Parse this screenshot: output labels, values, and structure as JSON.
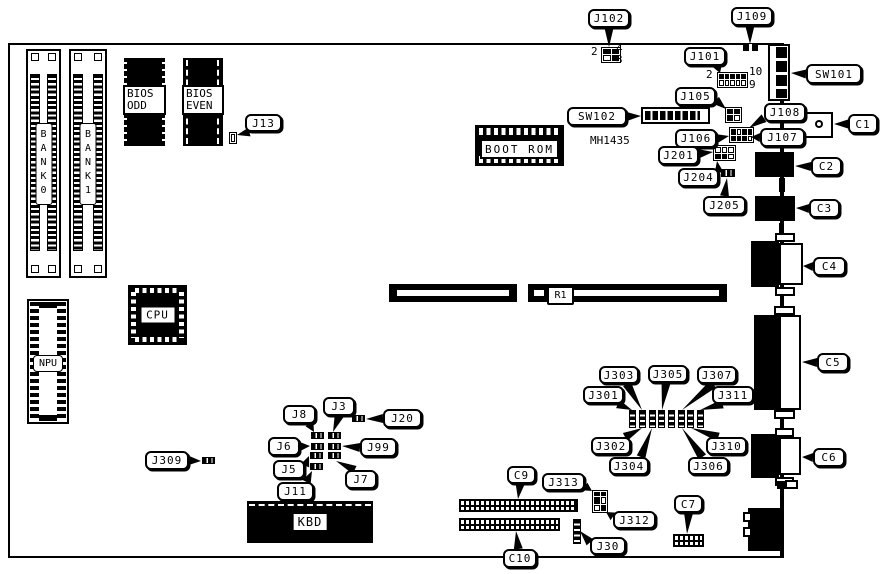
{
  "figure": {
    "width": 881,
    "height": 574,
    "ink": "#000000",
    "paper": "#ffffff"
  },
  "board": {
    "x": 8,
    "y": 43,
    "w": 770,
    "h": 511
  },
  "components": {
    "bank0": {
      "label": "BANK0"
    },
    "bank1": {
      "label": "BANK1"
    },
    "bios_odd": {
      "line1": "BIOS",
      "line2": "ODD"
    },
    "bios_even": {
      "line1": "BIOS",
      "line2": "EVEN"
    },
    "boot_rom": {
      "label": "BOOT ROM"
    },
    "cpu": {
      "label": "CPU"
    },
    "npu": {
      "label": "NPU"
    },
    "kbd": {
      "label": "KBD"
    },
    "r1": {
      "label": "R1"
    }
  },
  "texts": [
    {
      "id": "j102-pin-2",
      "text": "2",
      "x": 591,
      "y": 45
    },
    {
      "id": "j102-pin-4",
      "text": "4",
      "x": 616,
      "y": 42
    },
    {
      "id": "j102-pin-3",
      "text": "3",
      "x": 616,
      "y": 53
    },
    {
      "id": "j101-pin-2",
      "text": "2",
      "x": 706,
      "y": 68
    },
    {
      "id": "j101-pin-10",
      "text": "10",
      "x": 749,
      "y": 65
    },
    {
      "id": "j101-pin-9",
      "text": "9",
      "x": 749,
      "y": 78
    },
    {
      "id": "sw102-part-number",
      "text": "MH1435",
      "x": 590,
      "y": 134
    }
  ],
  "callouts": [
    {
      "label": "J102",
      "x": 588,
      "y": 9,
      "w": 42,
      "h": 19,
      "side": "bottom",
      "off": 0.5,
      "tx": 609,
      "ty": 47
    },
    {
      "label": "J109",
      "x": 731,
      "y": 7,
      "w": 42,
      "h": 19,
      "side": "bottom",
      "off": 0.45,
      "tx": 750,
      "ty": 44
    },
    {
      "label": "J101",
      "x": 684,
      "y": 47,
      "w": 42,
      "h": 19,
      "side": "bottom",
      "off": 0.8,
      "tx": 720,
      "ty": 73
    },
    {
      "label": "SW101",
      "x": 806,
      "y": 64,
      "w": 56,
      "h": 20,
      "side": "left",
      "off": 0.5,
      "tx": 791,
      "ty": 73
    },
    {
      "label": "SW102",
      "x": 567,
      "y": 107,
      "w": 60,
      "h": 19,
      "side": "right",
      "off": 0.5,
      "tx": 641,
      "ty": 116
    },
    {
      "label": "J105",
      "x": 675,
      "y": 87,
      "w": 41,
      "h": 19,
      "side": "right",
      "off": 0.7,
      "tx": 726,
      "ty": 109
    },
    {
      "label": "J108",
      "x": 764,
      "y": 103,
      "w": 42,
      "h": 19,
      "side": "left",
      "off": 0.8,
      "tx": 749,
      "ty": 128
    },
    {
      "label": "J106",
      "x": 675,
      "y": 129,
      "w": 42,
      "h": 19,
      "side": "right",
      "off": 0.5,
      "tx": 729,
      "ty": 136
    },
    {
      "label": "J107",
      "x": 760,
      "y": 128,
      "w": 45,
      "h": 19,
      "side": "left",
      "off": 0.5,
      "tx": 751,
      "ty": 137
    },
    {
      "label": "J201",
      "x": 658,
      "y": 146,
      "w": 41,
      "h": 19,
      "side": "right",
      "off": 0.4,
      "tx": 713,
      "ty": 152
    },
    {
      "label": "J204",
      "x": 678,
      "y": 168,
      "w": 41,
      "h": 19,
      "side": "right",
      "off": 0.25,
      "tx": 717,
      "ty": 161
    },
    {
      "label": "J205",
      "x": 703,
      "y": 196,
      "w": 43,
      "h": 19,
      "side": "top",
      "off": 0.5,
      "tx": 727,
      "ty": 178
    },
    {
      "label": "C1",
      "x": 848,
      "y": 114,
      "w": 30,
      "h": 20,
      "side": "left",
      "off": 0.5,
      "tx": 834,
      "ty": 124
    },
    {
      "label": "C2",
      "x": 811,
      "y": 157,
      "w": 31,
      "h": 19,
      "side": "left",
      "off": 0.5,
      "tx": 795,
      "ty": 166
    },
    {
      "label": "C3",
      "x": 809,
      "y": 199,
      "w": 31,
      "h": 19,
      "side": "left",
      "off": 0.5,
      "tx": 796,
      "ty": 208
    },
    {
      "label": "C4",
      "x": 813,
      "y": 257,
      "w": 33,
      "h": 19,
      "side": "left",
      "off": 0.5,
      "tx": 803,
      "ty": 266
    },
    {
      "label": "C5",
      "x": 817,
      "y": 353,
      "w": 32,
      "h": 19,
      "side": "left",
      "off": 0.5,
      "tx": 802,
      "ty": 362
    },
    {
      "label": "C6",
      "x": 813,
      "y": 448,
      "w": 32,
      "h": 19,
      "side": "left",
      "off": 0.5,
      "tx": 802,
      "ty": 457
    },
    {
      "label": "J13",
      "x": 245,
      "y": 114,
      "w": 37,
      "h": 18,
      "side": "bottom",
      "off": 0.12,
      "tx": 237,
      "ty": 135
    },
    {
      "label": "J309",
      "x": 145,
      "y": 451,
      "w": 44,
      "h": 19,
      "side": "right",
      "off": 0.5,
      "tx": 201,
      "ty": 461
    },
    {
      "label": "J8",
      "x": 283,
      "y": 405,
      "w": 33,
      "h": 19,
      "side": "bottom",
      "off": 0.8,
      "tx": 314,
      "ty": 432
    },
    {
      "label": "J3",
      "x": 323,
      "y": 397,
      "w": 32,
      "h": 19,
      "side": "bottom",
      "off": 0.5,
      "tx": 333,
      "ty": 432
    },
    {
      "label": "J20",
      "x": 383,
      "y": 409,
      "w": 39,
      "h": 19,
      "side": "left",
      "off": 0.5,
      "tx": 366,
      "ty": 419
    },
    {
      "label": "J6",
      "x": 268,
      "y": 437,
      "w": 32,
      "h": 19,
      "side": "right",
      "off": 0.5,
      "tx": 310,
      "ty": 446
    },
    {
      "label": "J99",
      "x": 360,
      "y": 438,
      "w": 37,
      "h": 19,
      "side": "left",
      "off": 0.5,
      "tx": 342,
      "ty": 446
    },
    {
      "label": "J5",
      "x": 273,
      "y": 460,
      "w": 32,
      "h": 19,
      "side": "right",
      "off": 0.3,
      "tx": 309,
      "ty": 456
    },
    {
      "label": "J7",
      "x": 345,
      "y": 470,
      "w": 32,
      "h": 19,
      "side": "top",
      "off": 0.3,
      "tx": 336,
      "ty": 461
    },
    {
      "label": "J11",
      "x": 277,
      "y": 482,
      "w": 37,
      "h": 19,
      "side": "top",
      "off": 0.8,
      "tx": 312,
      "ty": 471
    },
    {
      "label": "J301",
      "x": 583,
      "y": 386,
      "w": 41,
      "h": 18,
      "side": "bottom",
      "off": 0.85,
      "tx": 632,
      "ty": 410
    },
    {
      "label": "J303",
      "x": 599,
      "y": 366,
      "w": 40,
      "h": 18,
      "side": "bottom",
      "off": 0.7,
      "tx": 642,
      "ty": 410
    },
    {
      "label": "J305",
      "x": 648,
      "y": 365,
      "w": 40,
      "h": 18,
      "side": "bottom",
      "off": 0.45,
      "tx": 662,
      "ty": 410
    },
    {
      "label": "J307",
      "x": 697,
      "y": 366,
      "w": 40,
      "h": 18,
      "side": "bottom",
      "off": 0.4,
      "tx": 682,
      "ty": 410
    },
    {
      "label": "J311",
      "x": 712,
      "y": 386,
      "w": 42,
      "h": 18,
      "side": "bottom",
      "off": 0.25,
      "tx": 700,
      "ty": 410
    },
    {
      "label": "J302",
      "x": 591,
      "y": 437,
      "w": 40,
      "h": 18,
      "side": "top",
      "off": 0.85,
      "tx": 642,
      "ty": 428
    },
    {
      "label": "J304",
      "x": 609,
      "y": 457,
      "w": 40,
      "h": 18,
      "side": "top",
      "off": 0.8,
      "tx": 652,
      "ty": 428
    },
    {
      "label": "J306",
      "x": 688,
      "y": 457,
      "w": 41,
      "h": 18,
      "side": "top",
      "off": 0.35,
      "tx": 682,
      "ty": 428
    },
    {
      "label": "J310",
      "x": 706,
      "y": 437,
      "w": 41,
      "h": 18,
      "side": "top",
      "off": 0.3,
      "tx": 691,
      "ty": 428
    },
    {
      "label": "C9",
      "x": 507,
      "y": 466,
      "w": 29,
      "h": 18,
      "side": "bottom",
      "off": 0.45,
      "tx": 518,
      "ty": 499
    },
    {
      "label": "C10",
      "x": 503,
      "y": 549,
      "w": 34,
      "h": 19,
      "side": "top",
      "off": 0.45,
      "tx": 516,
      "ty": 531
    },
    {
      "label": "J313",
      "x": 542,
      "y": 473,
      "w": 43,
      "h": 18,
      "side": "right",
      "off": 0.75,
      "tx": 592,
      "ty": 491
    },
    {
      "label": "J312",
      "x": 613,
      "y": 511,
      "w": 43,
      "h": 18,
      "side": "left",
      "off": 0.3,
      "tx": 606,
      "ty": 512
    },
    {
      "label": "J30",
      "x": 590,
      "y": 537,
      "w": 36,
      "h": 18,
      "side": "left",
      "off": 0.3,
      "tx": 580,
      "ty": 531
    },
    {
      "label": "C7",
      "x": 674,
      "y": 495,
      "w": 29,
      "h": 18,
      "side": "bottom",
      "off": 0.5,
      "tx": 687,
      "ty": 534
    }
  ],
  "parts": [
    {
      "id": "slot-left",
      "type": "black",
      "x": 389,
      "y": 284,
      "w": 128,
      "h": 18
    },
    {
      "id": "slot-left-stripe",
      "type": "white",
      "x": 397,
      "y": 290,
      "w": 112,
      "h": 6
    },
    {
      "id": "slot-right",
      "type": "black",
      "x": 528,
      "y": 284,
      "w": 199,
      "h": 18
    },
    {
      "id": "slot-right-stripe-a",
      "type": "white",
      "x": 534,
      "y": 290,
      "w": 10,
      "h": 6
    },
    {
      "id": "slot-right-stripe-b",
      "type": "white",
      "x": 573,
      "y": 290,
      "w": 146,
      "h": 6
    },
    {
      "id": "j109-block",
      "type": "tickrect",
      "x": 743,
      "y": 44,
      "w": 15,
      "h": 7
    },
    {
      "id": "j102-block",
      "type": "cellgrid",
      "x": 601,
      "y": 47,
      "w": 20,
      "h": 16,
      "cols": 2,
      "cells": [
        "b",
        "b",
        "w",
        "b"
      ]
    },
    {
      "id": "j101-header",
      "type": "cellgrid",
      "x": 717,
      "y": 72,
      "w": 31,
      "h": 16,
      "cols": 5,
      "cells": [
        "b",
        "b",
        "b",
        "b",
        "b",
        "w",
        "w",
        "w",
        "w",
        "w"
      ]
    },
    {
      "id": "j105-block",
      "type": "cellgrid",
      "x": 725,
      "y": 107,
      "w": 17,
      "h": 16,
      "cols": 2,
      "cells": [
        "b",
        "b",
        "b",
        "w"
      ]
    },
    {
      "id": "j106-j107-block",
      "type": "cellgrid",
      "x": 729,
      "y": 127,
      "w": 25,
      "h": 16,
      "cols": 4,
      "cells": [
        "b",
        "w",
        "b",
        "b",
        "b",
        "b",
        "b",
        "w"
      ]
    },
    {
      "id": "j201-block",
      "type": "cellgrid",
      "x": 713,
      "y": 145,
      "w": 23,
      "h": 16,
      "cols": 3,
      "cells": [
        "w",
        "w",
        "w",
        "b",
        "b",
        "w"
      ]
    },
    {
      "id": "j204-jumper",
      "type": "jmp-h",
      "x": 721,
      "y": 169,
      "w": 14,
      "h": 8
    },
    {
      "id": "j13-part",
      "type": "cellgrid",
      "x": 229,
      "y": 132,
      "w": 8,
      "h": 12,
      "cols": 1,
      "cells": [
        "w"
      ]
    },
    {
      "id": "c1-body",
      "type": "outline",
      "x": 782,
      "y": 112,
      "w": 51,
      "h": 26
    },
    {
      "id": "c1-hole",
      "type": "circle",
      "x": 815,
      "y": 120,
      "w": 8,
      "h": 8
    },
    {
      "id": "c2-body",
      "type": "black",
      "x": 755,
      "y": 152,
      "w": 39,
      "h": 25
    },
    {
      "id": "c3-body",
      "type": "black",
      "x": 755,
      "y": 196,
      "w": 40,
      "h": 25
    },
    {
      "id": "edge-nub-1",
      "type": "black",
      "x": 779,
      "y": 178,
      "w": 6,
      "h": 14
    },
    {
      "id": "edge-nub-2",
      "type": "black",
      "x": 779,
      "y": 223,
      "w": 5,
      "h": 10
    },
    {
      "id": "c4-body",
      "type": "black",
      "x": 751,
      "y": 241,
      "w": 28,
      "h": 46
    },
    {
      "id": "c4-face",
      "type": "outline",
      "x": 779,
      "y": 243,
      "w": 24,
      "h": 42
    },
    {
      "id": "c4-tab-top",
      "type": "outline",
      "x": 775,
      "y": 233,
      "w": 20,
      "h": 9
    },
    {
      "id": "c4-tab-bottom",
      "type": "outline",
      "x": 775,
      "y": 287,
      "w": 20,
      "h": 9
    },
    {
      "id": "c5-body",
      "type": "black",
      "x": 754,
      "y": 315,
      "w": 25,
      "h": 95
    },
    {
      "id": "c5-face",
      "type": "outline",
      "x": 779,
      "y": 315,
      "w": 22,
      "h": 95
    },
    {
      "id": "c5-tab-top",
      "type": "outline",
      "x": 774,
      "y": 306,
      "w": 21,
      "h": 9
    },
    {
      "id": "c5-tab-bottom",
      "type": "outline",
      "x": 774,
      "y": 410,
      "w": 21,
      "h": 9
    },
    {
      "id": "c6-body",
      "type": "black",
      "x": 751,
      "y": 434,
      "w": 28,
      "h": 44
    },
    {
      "id": "c6-face",
      "type": "outline",
      "x": 779,
      "y": 437,
      "w": 22,
      "h": 38
    },
    {
      "id": "c6-tab-top",
      "type": "outline",
      "x": 775,
      "y": 428,
      "w": 19,
      "h": 9
    },
    {
      "id": "c6-tab-bottom",
      "type": "outline",
      "x": 775,
      "y": 477,
      "w": 19,
      "h": 9
    },
    {
      "id": "kbd-din-body",
      "type": "black",
      "x": 748,
      "y": 508,
      "w": 35,
      "h": 43
    },
    {
      "id": "kbd-din-bump-1",
      "type": "outline",
      "x": 743,
      "y": 512,
      "w": 9,
      "h": 10
    },
    {
      "id": "kbd-din-bump-2",
      "type": "outline",
      "x": 743,
      "y": 527,
      "w": 9,
      "h": 10
    },
    {
      "id": "edge-part-black",
      "type": "black",
      "x": 777,
      "y": 481,
      "w": 9,
      "h": 8
    },
    {
      "id": "edge-part-outline",
      "type": "outline",
      "x": 785,
      "y": 480,
      "w": 13,
      "h": 9
    },
    {
      "id": "c9-header",
      "type": "pingrid",
      "x": 459,
      "y": 499,
      "w": 119,
      "h": 13
    },
    {
      "id": "c10-header",
      "type": "pingrid",
      "x": 459,
      "y": 518,
      "w": 101,
      "h": 13
    },
    {
      "id": "c7-header",
      "type": "pingrid",
      "x": 673,
      "y": 534,
      "w": 31,
      "h": 13
    },
    {
      "id": "j30-strip",
      "type": "ladder-v",
      "x": 573,
      "y": 519,
      "w": 8,
      "h": 25
    },
    {
      "id": "j313-j312-block",
      "type": "cellgrid",
      "x": 592,
      "y": 490,
      "w": 16,
      "h": 23,
      "cols": 2,
      "cells": [
        "b",
        "b",
        "b",
        "w",
        "w",
        "b"
      ]
    },
    {
      "id": "j3xx-jumper-1",
      "type": "ladder-v",
      "x": 629,
      "y": 410,
      "w": 7,
      "h": 18
    },
    {
      "id": "j3xx-jumper-2",
      "type": "ladder-v",
      "x": 639,
      "y": 410,
      "w": 7,
      "h": 18
    },
    {
      "id": "j3xx-jumper-3",
      "type": "ladder-v",
      "x": 649,
      "y": 410,
      "w": 7,
      "h": 18
    },
    {
      "id": "j3xx-jumper-4",
      "type": "ladder-v",
      "x": 658,
      "y": 410,
      "w": 7,
      "h": 18
    },
    {
      "id": "j3xx-jumper-5",
      "type": "ladder-v",
      "x": 668,
      "y": 410,
      "w": 7,
      "h": 18
    },
    {
      "id": "j3xx-jumper-6",
      "type": "ladder-v",
      "x": 678,
      "y": 410,
      "w": 7,
      "h": 18
    },
    {
      "id": "j3xx-jumper-7",
      "type": "ladder-v",
      "x": 687,
      "y": 410,
      "w": 7,
      "h": 18
    },
    {
      "id": "j3xx-jumper-8",
      "type": "ladder-v",
      "x": 697,
      "y": 410,
      "w": 7,
      "h": 18
    },
    {
      "id": "j8-jumper",
      "type": "jmp-h",
      "x": 311,
      "y": 432,
      "w": 13,
      "h": 7
    },
    {
      "id": "j3-jumper",
      "type": "jmp-h",
      "x": 328,
      "y": 432,
      "w": 13,
      "h": 7
    },
    {
      "id": "j6-jumper",
      "type": "jmp-h",
      "x": 311,
      "y": 443,
      "w": 13,
      "h": 7
    },
    {
      "id": "j99-jumper",
      "type": "jmp-h",
      "x": 328,
      "y": 443,
      "w": 13,
      "h": 7
    },
    {
      "id": "j5-jumper",
      "type": "jmp-h",
      "x": 310,
      "y": 452,
      "w": 13,
      "h": 7
    },
    {
      "id": "j7-jumper",
      "type": "jmp-h",
      "x": 328,
      "y": 452,
      "w": 13,
      "h": 7
    },
    {
      "id": "j11-jumper",
      "type": "jmp-h",
      "x": 310,
      "y": 463,
      "w": 13,
      "h": 7
    },
    {
      "id": "j20-jumper",
      "type": "jmp-h",
      "x": 352,
      "y": 415,
      "w": 13,
      "h": 7
    },
    {
      "id": "j309-jumper",
      "type": "jmp-h",
      "x": 202,
      "y": 457,
      "w": 13,
      "h": 7
    }
  ]
}
